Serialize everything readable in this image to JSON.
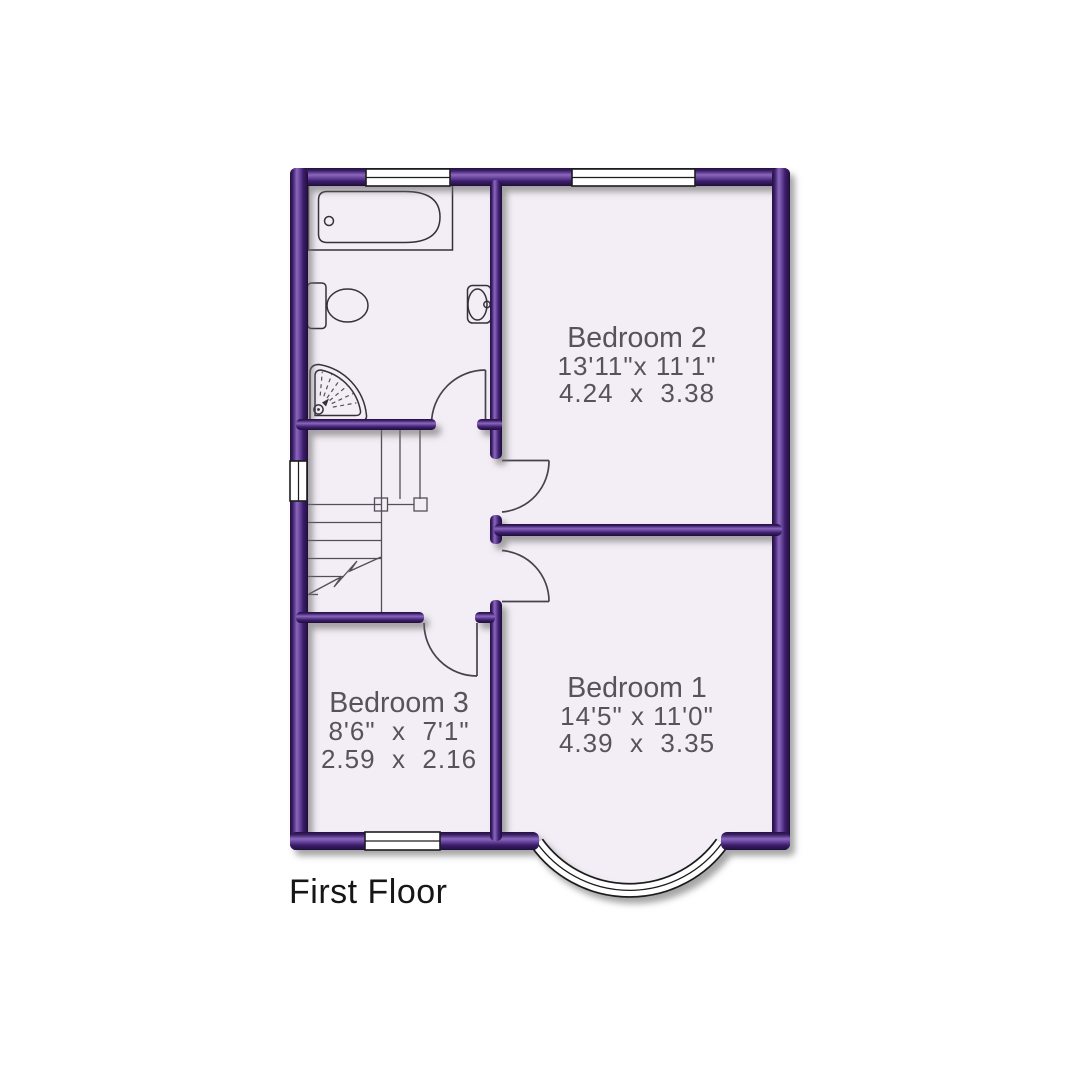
{
  "title": "First Floor",
  "rooms": [
    {
      "name": "Bedroom 2",
      "imperial": "13'11\"x 11'1\"",
      "metric": "4.24  x  3.38"
    },
    {
      "name": "Bedroom 1",
      "imperial": "14'5\" x 11'0\"",
      "metric": "4.39  x  3.35"
    },
    {
      "name": "Bedroom 3",
      "imperial": "8'6\"  x  7'1\"",
      "metric": "2.59  x  2.16"
    }
  ],
  "colors": {
    "wall_dark": "#241039",
    "wall_highlight": "#8a67bd",
    "floor": "#f3edf5",
    "room_label": "#57525c",
    "title": "#161616",
    "window_fill": "#ffffff"
  }
}
